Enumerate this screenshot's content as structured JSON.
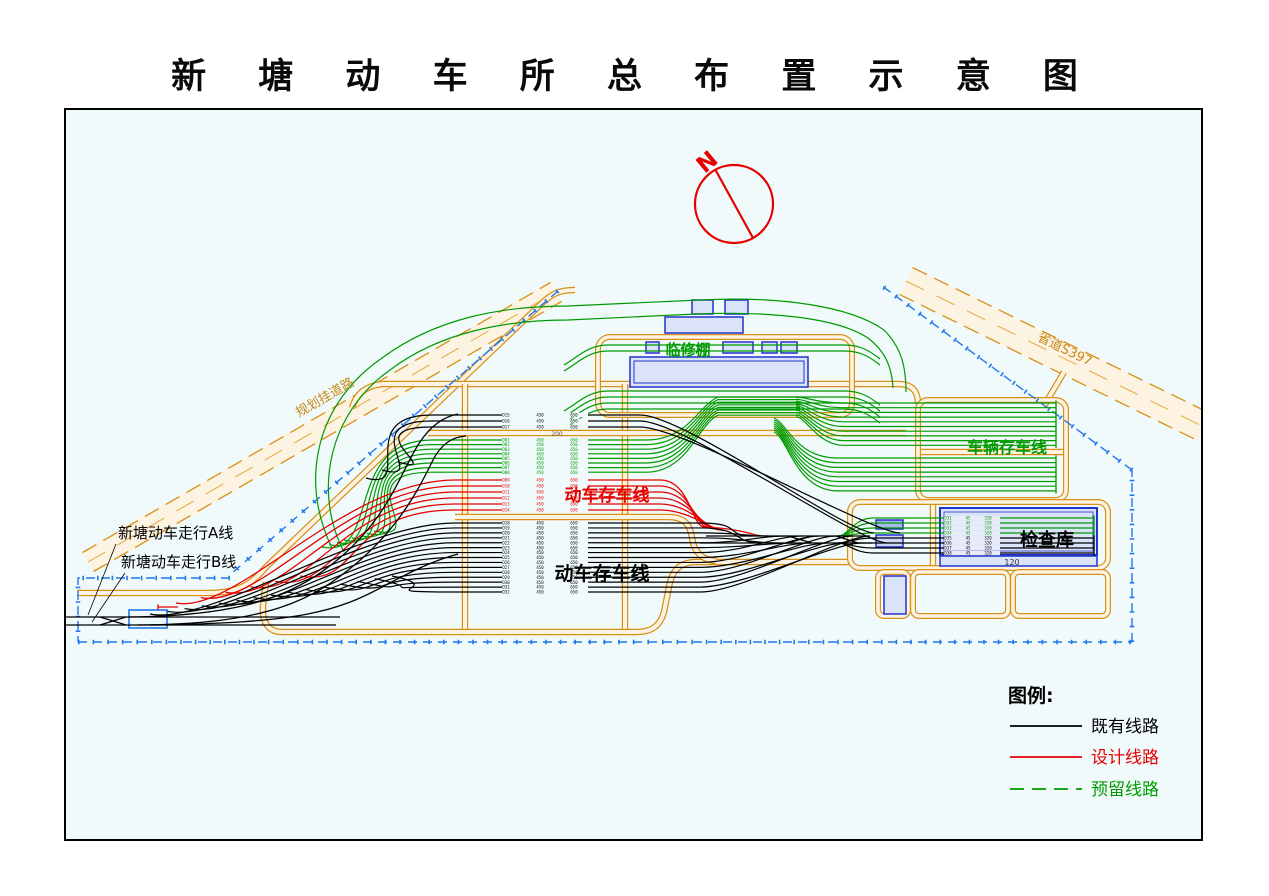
{
  "title": "新 塘 动 车 所 总 布 置 示 意 图",
  "north": {
    "label": "N"
  },
  "legend": {
    "title": "图例:",
    "items": [
      {
        "label": "既有线路",
        "color": "#000000",
        "dash": ""
      },
      {
        "label": "设计线路",
        "color": "#e60000",
        "dash": ""
      },
      {
        "label": "预留线路",
        "color": "#009a00",
        "dash": "14 8"
      }
    ]
  },
  "labels": [
    {
      "id": "linxiupeng",
      "text": "临修棚",
      "x": 688,
      "y": 355,
      "size": 15,
      "color": "#009a00",
      "anchor": "middle",
      "bold": true
    },
    {
      "id": "cheliang-cunchexian",
      "text": "车辆存车线",
      "x": 1007,
      "y": 453,
      "size": 16,
      "color": "#009a00",
      "anchor": "middle",
      "bold": true
    },
    {
      "id": "dongche-cunchexian-design",
      "text": "动车存车线",
      "x": 607,
      "y": 501,
      "size": 17,
      "color": "#e60000",
      "anchor": "middle",
      "bold": true
    },
    {
      "id": "dongche-cunchexian-existing",
      "text": "动车存车线",
      "x": 602,
      "y": 580,
      "size": 19,
      "color": "#000000",
      "anchor": "middle",
      "bold": true
    },
    {
      "id": "jianchaku",
      "text": "检查库",
      "x": 1047,
      "y": 546,
      "size": 18,
      "color": "#000000",
      "anchor": "middle",
      "bold": true
    },
    {
      "id": "platform-length",
      "text": "120",
      "x": 1012,
      "y": 565,
      "size": 8,
      "color": "#333333",
      "anchor": "middle"
    },
    {
      "id": "walk-line-a",
      "text": "新塘动车走行A线",
      "x": 118,
      "y": 538,
      "size": 15,
      "color": "#000000",
      "anchor": "start"
    },
    {
      "id": "walk-line-b",
      "text": "新塘动车走行B线",
      "x": 121,
      "y": 567,
      "size": 15,
      "color": "#000000",
      "anchor": "start"
    },
    {
      "id": "planned-road",
      "text": "规划挂道路",
      "x": 327,
      "y": 401,
      "size": 13,
      "color": "#c8891a",
      "anchor": "middle",
      "rotate": -30
    },
    {
      "id": "provincial-road",
      "text": "省道S397",
      "x": 1063,
      "y": 353,
      "size": 13,
      "color": "#c8891a",
      "anchor": "middle",
      "rotate": 26
    },
    {
      "id": "band-number",
      "text": "200",
      "x": 557,
      "y": 436,
      "size": 6,
      "color": "#555555",
      "anchor": "middle"
    }
  ],
  "colors": {
    "existing": "#000000",
    "design": "#e60000",
    "reserved": "#009a00",
    "road": "#d89018",
    "road_fill": "#fdf3e2",
    "boundary": "#2277ee",
    "building_stroke": "#2233cc",
    "building_fill": "#dbe3f8",
    "canvas": "#f0fafb"
  },
  "frame": {
    "x": 65,
    "y": 109,
    "w": 1137,
    "h": 731
  },
  "boundary_paths": [
    "M 558 291 L 232 573",
    "M 230 578 L 78 578 L 78 642",
    "M 78 642 L 1132 642",
    "M 1132 642 L 1132 470",
    "M 1132 470 L 882 286"
  ],
  "diagonal_roads": [
    {
      "x1": 88,
      "y1": 562,
      "x2": 556,
      "y2": 292,
      "width": 24,
      "px": 5.5,
      "py": 9.5
    },
    {
      "x1": 906,
      "y1": 281,
      "x2": 1204,
      "y2": 427,
      "width": 30,
      "px": -6.6,
      "py": 13.4
    }
  ],
  "road_paths": [
    "M 77 593 H 208 C 238 593, 252 584, 266 567 L 540 305 C 552 293, 560 290, 575 290",
    "M 352 408 C 356 394, 366 385, 384 384 L 898 384 C 912 384, 918 391, 918 404",
    "M 465 384 V 630",
    "M 625 384 V 630",
    "M 282 632 H 636 C 652 632, 660 626, 664 612 L 670 582 C 674 568, 682 562, 696 562 L 852 562",
    "M 282 632 C 268 632, 262 622, 263 606 L 266 582",
    "M 428 433 H 906",
    "M 455 517 H 668 C 684 517, 690 524, 692 538 C 694 552, 702 560, 716 561",
    "M 918 452 H 1066",
    "M 933 502 V 568",
    "M 1044 406 L 1064 372"
  ],
  "loop_roads": [
    {
      "x": 598,
      "y": 337,
      "w": 254,
      "h": 78,
      "r": 12
    },
    {
      "x": 918,
      "y": 400,
      "w": 148,
      "h": 100,
      "r": 10
    },
    {
      "x": 850,
      "y": 502,
      "w": 258,
      "h": 66,
      "r": 10
    },
    {
      "x": 878,
      "y": 572,
      "w": 30,
      "h": 44,
      "r": 6
    },
    {
      "x": 913,
      "y": 572,
      "w": 95,
      "h": 44,
      "r": 6
    },
    {
      "x": 1013,
      "y": 572,
      "w": 95,
      "h": 44,
      "r": 6
    }
  ],
  "buildings": [
    {
      "x": 630,
      "y": 357,
      "w": 178,
      "h": 30
    },
    {
      "x": 634,
      "y": 361,
      "w": 170,
      "h": 22,
      "fill": "none",
      "sw": 1
    },
    {
      "x": 692,
      "y": 300,
      "w": 21,
      "h": 14
    },
    {
      "x": 725,
      "y": 300,
      "w": 23,
      "h": 14
    },
    {
      "x": 665,
      "y": 317,
      "w": 78,
      "h": 16
    },
    {
      "x": 646,
      "y": 342,
      "w": 13,
      "h": 11
    },
    {
      "x": 723,
      "y": 342,
      "w": 30,
      "h": 11
    },
    {
      "x": 762,
      "y": 342,
      "w": 15,
      "h": 11
    },
    {
      "x": 781,
      "y": 342,
      "w": 16,
      "h": 11
    },
    {
      "x": 940,
      "y": 508,
      "w": 157,
      "h": 47,
      "sw": 2
    },
    {
      "x": 944,
      "y": 512,
      "w": 149,
      "h": 39,
      "fill": "none",
      "sw": 0.8
    },
    {
      "x": 940,
      "y": 556,
      "w": 157,
      "h": 10
    },
    {
      "x": 876,
      "y": 520,
      "w": 27,
      "h": 9,
      "fill": "#aab8f0"
    },
    {
      "x": 876,
      "y": 535,
      "w": 27,
      "h": 12,
      "fill": "#ccd6f6"
    },
    {
      "x": 884,
      "y": 576,
      "w": 22,
      "h": 38
    },
    {
      "x": 129,
      "y": 610,
      "w": 38,
      "h": 18,
      "fill": "none",
      "stroke": "#2277ee",
      "sw": 1.6
    }
  ],
  "fans": {
    "top_black": {
      "y0": 415,
      "dy": 6,
      "n": 3,
      "x0": 432,
      "x1": 640,
      "left": {
        "tx0": 366,
        "ty0": 478,
        "tx1": 398,
        "ty1": 462,
        "pull": 80,
        "ctl": 50,
        "ctly": 14
      },
      "right": {
        "ex0": 874,
        "dex": 13,
        "eyA": 533,
        "eyB": 543
      }
    },
    "green_yard": {
      "y0": 440,
      "dy": 4.6,
      "n": 8,
      "x0": 432,
      "x1": 646,
      "left": {
        "tx0": 322,
        "ty0": 547,
        "tx1": 374,
        "ty1": 531,
        "pull": 90,
        "ctl": 60,
        "ctly": 12
      },
      "bundle": {
        "by0": 397,
        "dby": 2.6,
        "hx": 800
      }
    },
    "red_yard": {
      "y0": 480,
      "dy": 6,
      "n": 6,
      "x0": 455,
      "x1": 660,
      "left": {
        "tx0": 176,
        "ty0": 603,
        "tx1": 300,
        "ty1": 576,
        "pull": 110,
        "ctl": 60,
        "ctly": 12
      },
      "right": {
        "ex0": 704,
        "dex": 4,
        "ey0": 527,
        "dey": 0.7
      }
    },
    "black_yard": {
      "y0": 523,
      "dy": 4.93,
      "n": 15,
      "x0": 455,
      "x1": 700,
      "left": {
        "tx0": 150,
        "ty0": 614,
        "tx1": 392,
        "ty1": 576,
        "pull": 95,
        "ctl": 60,
        "ctly": 12
      },
      "right": {
        "ex0": 752,
        "dex": 8.4,
        "eyA": 536,
        "eyB": 543
      }
    },
    "storage_upper": {
      "y0": 403,
      "dy": 4.7,
      "n": 10,
      "xr": 1056,
      "xk": 843,
      "sy0": 397,
      "dsy": 2.2
    },
    "storage_lower": {
      "y0": 458,
      "dy": 4.7,
      "n": 8,
      "xr": 1056,
      "xk": 838
    },
    "linxiu_lines": {
      "ys": [
        345,
        351,
        391,
        397,
        403,
        409
      ],
      "x0": 608,
      "x1": 845
    },
    "depot_green": {
      "y0": 518,
      "dy": 5,
      "n": 4,
      "xr": 1094,
      "xk": 873,
      "join": 536
    },
    "depot_black": {
      "y0": 538,
      "dy": 5,
      "n": 4,
      "xr": 1094,
      "xk": 873,
      "join": 543
    }
  },
  "tracks_black": [
    "M 66 617 H 340",
    "M 66 625 H 336",
    "M 100 617 L 126 625",
    "M 100 625 L 126 617",
    "M 128 617 C 252 616, 300 592, 342 556 C 392 512, 402 468, 420 442 C 430 427, 442 417, 458 414",
    "M 138 625 C 268 624, 312 601, 358 562 C 402 524, 420 486, 434 458 C 442 444, 452 437, 466 436",
    "M 150 625 C 300 623, 336 612, 384 586 C 420 567, 436 560, 458 554",
    "M 706 536 H 870",
    "M 700 543 H 872",
    "M 788 536 L 812 543",
    "M 788 543 L 812 536",
    "M 836 536 L 858 543"
  ],
  "tracks_red": [
    "M 158 607 H 178",
    "M 704 527 C 728 528, 742 531, 756 535 L 762 536"
  ],
  "tracks_green": [
    "M 332 548 C 298 478, 318 402, 382 358 C 436 318, 502 306, 568 306 L 700 300 C 780 296, 850 306, 884 330 C 902 348, 906 368, 906 392",
    "M 344 552 C 312 490, 330 412, 390 370 C 440 332, 506 320, 568 320 L 696 314 C 772 311, 838 318, 868 338 C 886 352, 892 368, 893 388"
  ],
  "leader_lines": [
    "M 116 544 L 88 615",
    "M 125 573 L 92 622"
  ],
  "micro": {
    "cols": [
      506,
      540,
      574
    ],
    "tokens": [
      "450",
      "650"
    ],
    "prefix": "D",
    "depot_cols": [
      948,
      968,
      988
    ],
    "depot_tokens": [
      "45",
      "320"
    ]
  },
  "north_geo": {
    "cx": 734,
    "cy": 204,
    "r": 39,
    "lx1": 715,
    "ly1": 169,
    "lx2": 753,
    "ly2": 238,
    "tx": 712,
    "ty": 168,
    "rot": -40
  },
  "legend_geo": {
    "tx": 1008,
    "ty": 702,
    "lx1": 1010,
    "lx2": 1082,
    "txx": 1091,
    "ys": [
      726,
      757,
      789
    ]
  }
}
